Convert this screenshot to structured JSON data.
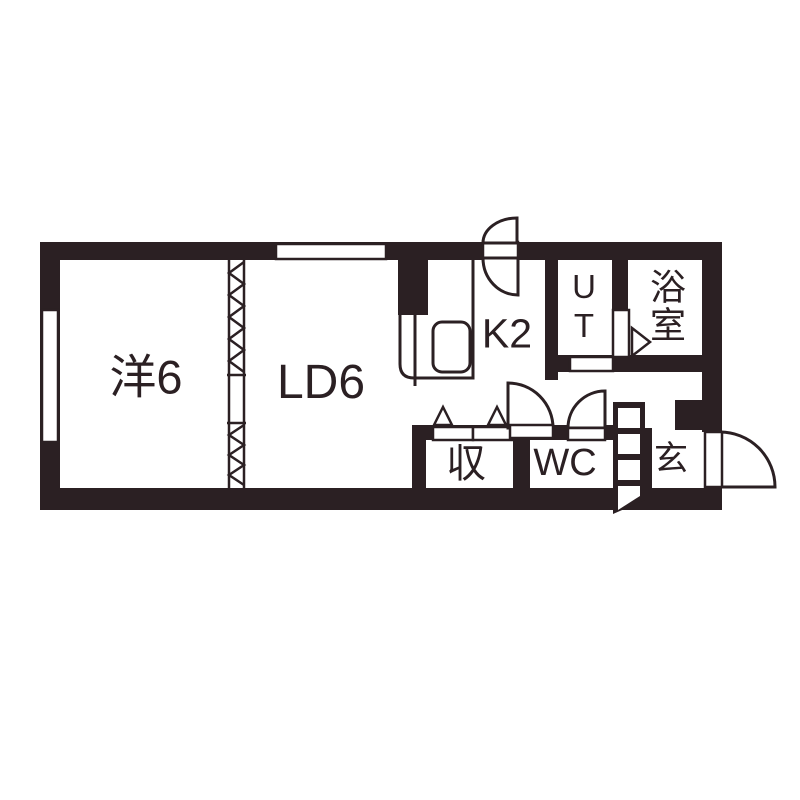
{
  "colors": {
    "ink": "#2b2023",
    "background": "#ffffff"
  },
  "floorplan": {
    "type": "apartment-floor-plan",
    "rooms": [
      {
        "name": "western-room",
        "label": "洋6"
      },
      {
        "name": "living-dining",
        "label": "LD6"
      },
      {
        "name": "kitchen",
        "label": "K2"
      },
      {
        "name": "utility",
        "label": "UT"
      },
      {
        "name": "bathroom",
        "label": "浴室"
      },
      {
        "name": "storage",
        "label": "収"
      },
      {
        "name": "toilet",
        "label": "WC"
      },
      {
        "name": "entrance",
        "label": "玄"
      }
    ]
  }
}
